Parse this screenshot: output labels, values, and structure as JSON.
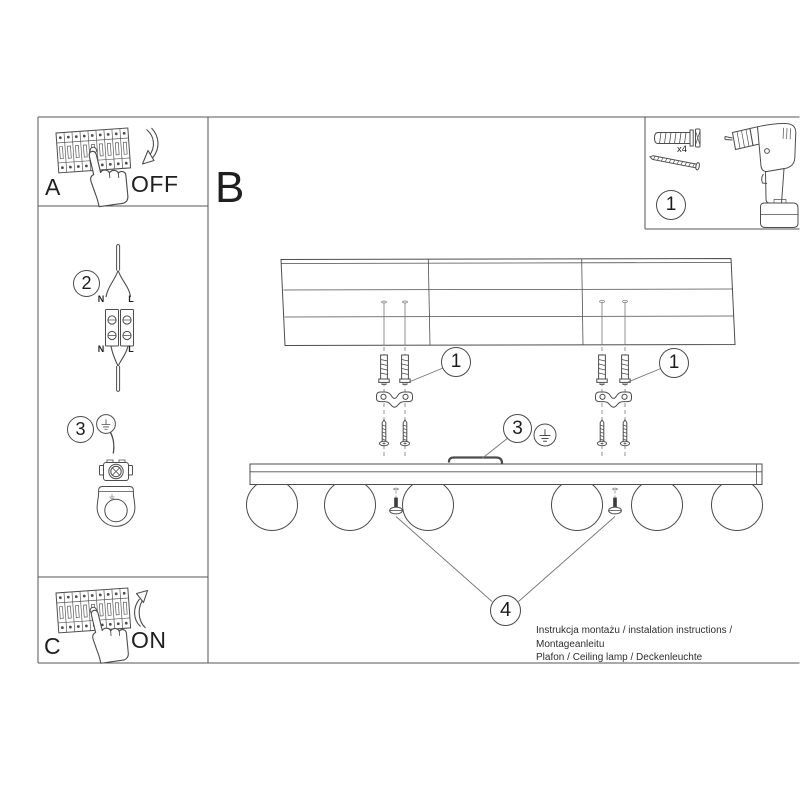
{
  "colors": {
    "line": "#4d4d4d",
    "text": "#1f1f1f"
  },
  "panel_a": {
    "label": "A",
    "switch_state": "OFF"
  },
  "section_b": {
    "label": "B"
  },
  "panel_c": {
    "label": "C",
    "switch_state": "ON"
  },
  "parts_box": {
    "callout": "1",
    "anchor_qty": "x4"
  },
  "wiring_step": {
    "callout": "2",
    "top_left": "N",
    "top_right": "L",
    "bottom_left": "N",
    "bottom_right": "L"
  },
  "ground_step": {
    "callout": "3"
  },
  "diagram": {
    "anchor_callout_left": "1",
    "anchor_callout_right": "1",
    "ground_callout": "3",
    "screw_callout": "4"
  },
  "footer": {
    "line1": "Instrukcja montażu / instalation instructions / Montageanleitu",
    "line2": "Plafon / Ceiling lamp / Deckenleuchte"
  }
}
